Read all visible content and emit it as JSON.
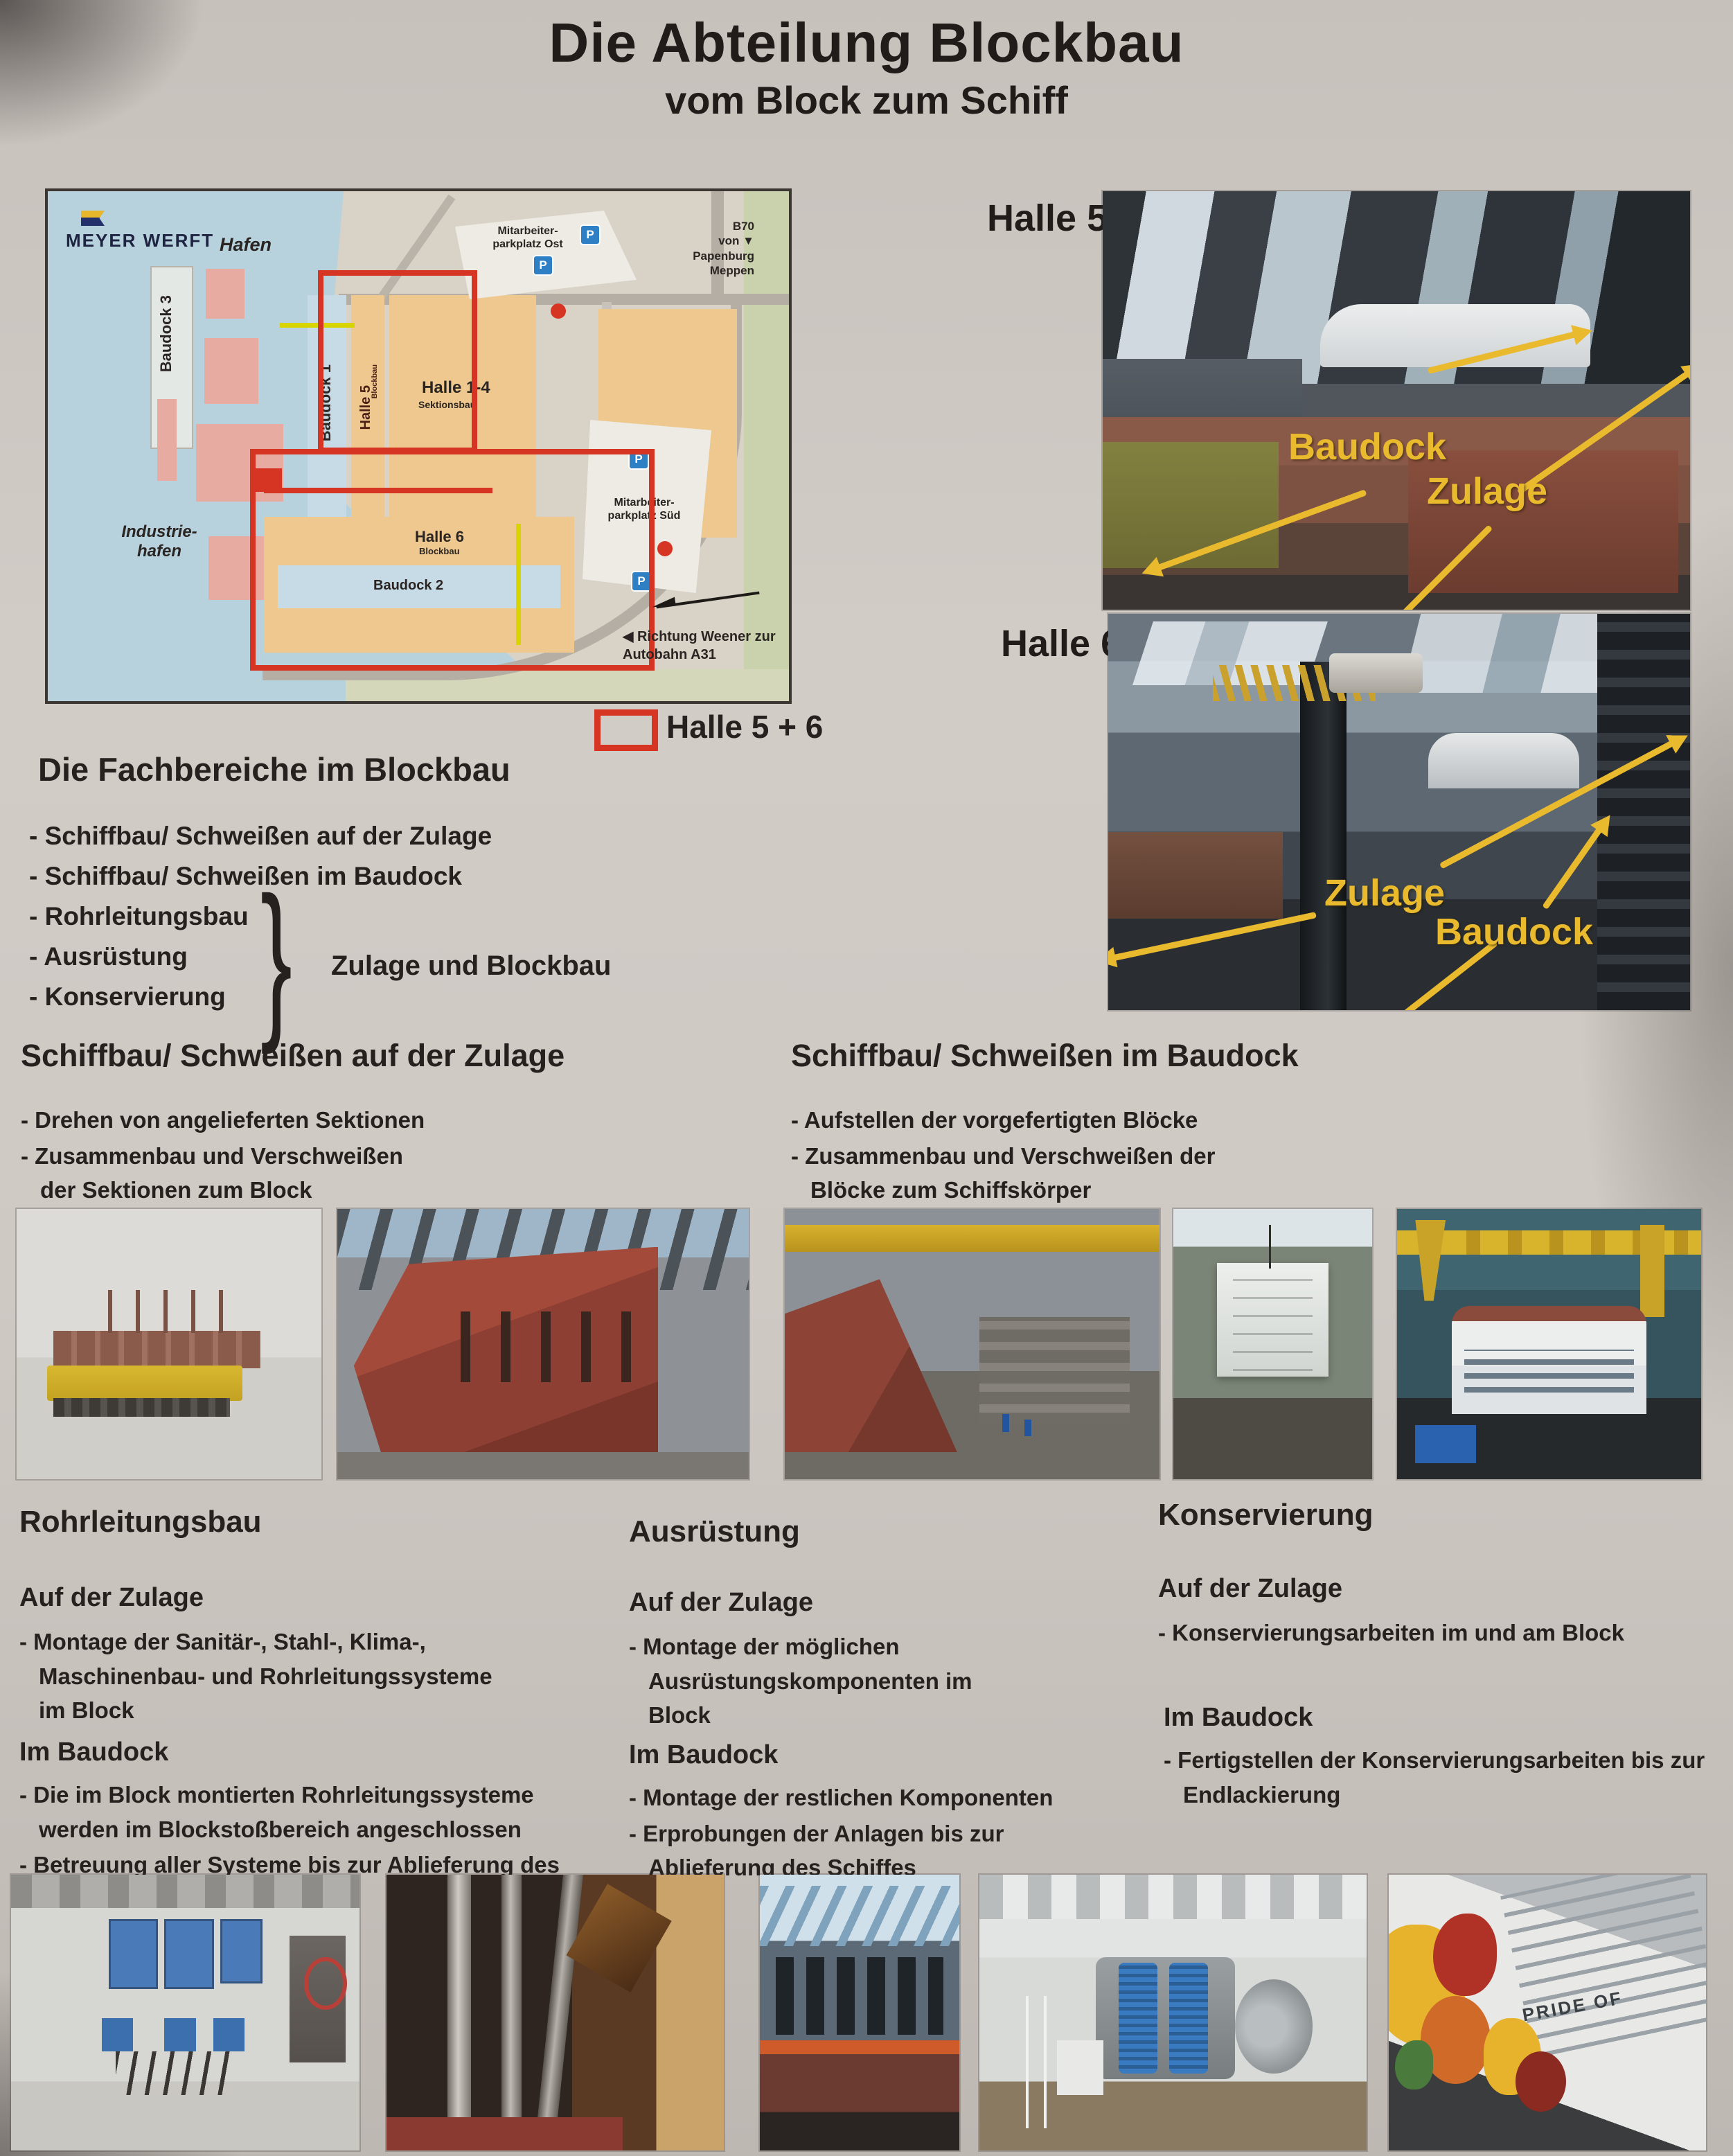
{
  "poster": {
    "title": "Die Abteilung Blockbau",
    "subtitle": "vom Block zum Schiff"
  },
  "map": {
    "logo_text": "MEYER WERFT",
    "hafen": "Hafen",
    "industriehafen": "Industrie- hafen",
    "baudock3": "Baudock 3",
    "baudock1": "Baudock 1",
    "halle5": "Halle 5",
    "halle5_sub": "Blockbau",
    "halle14": "Halle 1-4",
    "halle14_sub": "Sektionsbau",
    "halle79": "Halle 7-9",
    "halle79_sub": "Vorfertigung",
    "halle6": "Halle 6",
    "halle6_sub": "Blockbau",
    "baudock2": "Baudock 2",
    "parkplatz_ost": "Mitarbeiter- parkplatz Ost",
    "parkplatz_sued": "Mitarbeiter- parkplatz Süd",
    "b70_lines": [
      "B70",
      "von",
      "Papenburg",
      "Meppen"
    ],
    "b70_marker": "▼",
    "richtung_marker": "◀",
    "richtung": "Richtung Weener zur Autobahn A31",
    "parking_label": "P",
    "legend_label": "Halle 5 + 6"
  },
  "fachbereiche": {
    "heading": "Die Fachbereiche im Blockbau",
    "items": [
      "- Schiffbau/ Schweißen auf der Zulage",
      "- Schiffbau/ Schweißen im Baudock",
      "- Rohrleitungsbau",
      "- Ausrüstung",
      "- Konservierung"
    ],
    "brace": "}",
    "brace_label": "Zulage und Blockbau"
  },
  "halle5_photo": {
    "label": "Halle 5",
    "baudock": "Baudock",
    "zulage": "Zulage"
  },
  "halle6_photo": {
    "label": "Halle 6",
    "zulage": "Zulage",
    "baudock": "Baudock"
  },
  "zulage_section": {
    "heading": "Schiffbau/ Schweißen auf der Zulage",
    "bullets": [
      "- Drehen von angelieferten Sektionen",
      "- Zusammenbau und Verschweißen der Sektionen zum Block"
    ]
  },
  "baudock_section": {
    "heading": "Schiffbau/ Schweißen im Baudock",
    "bullets": [
      "- Aufstellen der vorgefertigten Blöcke",
      "- Zusammenbau und Verschweißen der Blöcke zum Schiffskörper"
    ]
  },
  "rohrleitungsbau": {
    "heading": "Rohrleitungsbau",
    "zulage_heading": "Auf der Zulage",
    "zulage_bullets": [
      "- Montage der Sanitär-, Stahl-, Klima-, Maschinenbau- und Rohrleitungssysteme im Block"
    ],
    "baudock_heading": "Im Baudock",
    "baudock_bullets": [
      "- Die im Block montierten Rohrleitungssysteme werden im Blockstoßbereich angeschlossen",
      "- Betreuung aller Systeme bis zur Ablieferung des Schiffes"
    ]
  },
  "ausruestung": {
    "heading": "Ausrüstung",
    "zulage_heading": "Auf der Zulage",
    "zulage_bullets": [
      "- Montage der möglichen Ausrüstungskomponenten im Block"
    ],
    "baudock_heading": "Im Baudock",
    "baudock_bullets": [
      "- Montage der restlichen Komponenten",
      "- Erprobungen der Anlagen bis zur Ablieferung des Schiffes"
    ]
  },
  "konservierung": {
    "heading": "Konservierung",
    "zulage_heading": "Auf der Zulage",
    "zulage_bullets": [
      "- Konservierungsarbeiten im und am Block"
    ],
    "baudock_heading": "Im Baudock",
    "baudock_bullets": [
      "- Fertigstellen der Konservierungsarbeiten bis zur Endlackierung"
    ]
  },
  "photos": {
    "pride_text": "PRIDE OF"
  }
}
